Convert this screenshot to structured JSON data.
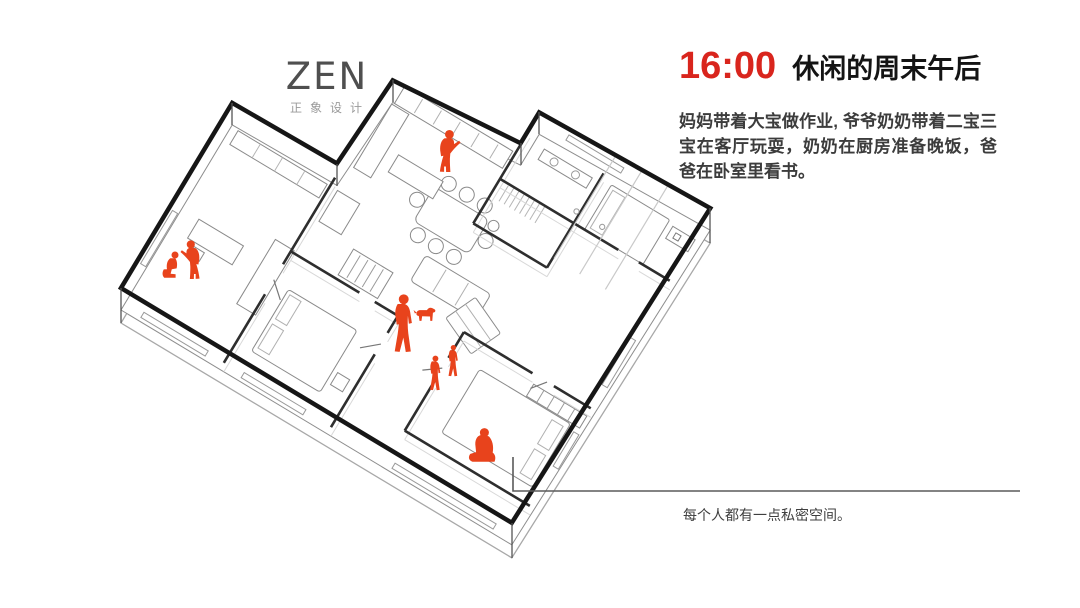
{
  "slide": {
    "background_color": "#ffffff",
    "logo": {
      "text": "ZEN",
      "subtext": "正象设计"
    },
    "header": {
      "time": "16:00",
      "time_color": "#d9251d",
      "title": "休闲的周末午后"
    },
    "description": "妈妈带着大宝做作业, 爷爷奶奶带着二宝三宝在客厅玩耍，奶奶在厨房准备晚饭，爸爸在卧室里看书。",
    "annotation": {
      "text": "每个人都有一点私密空间。"
    },
    "drawing": {
      "type": "axonometric-floor-plan",
      "figure_color": "#e8431c",
      "wall_color": "#161616",
      "figures": [
        "mother-standing-at-desk",
        "eldest-child-sitting-at-desk",
        "grandma-cooking-in-kitchen",
        "grandpa-standing-in-living-room",
        "second-child-playing",
        "third-child-playing",
        "dog",
        "father-reading-on-bed"
      ]
    }
  }
}
